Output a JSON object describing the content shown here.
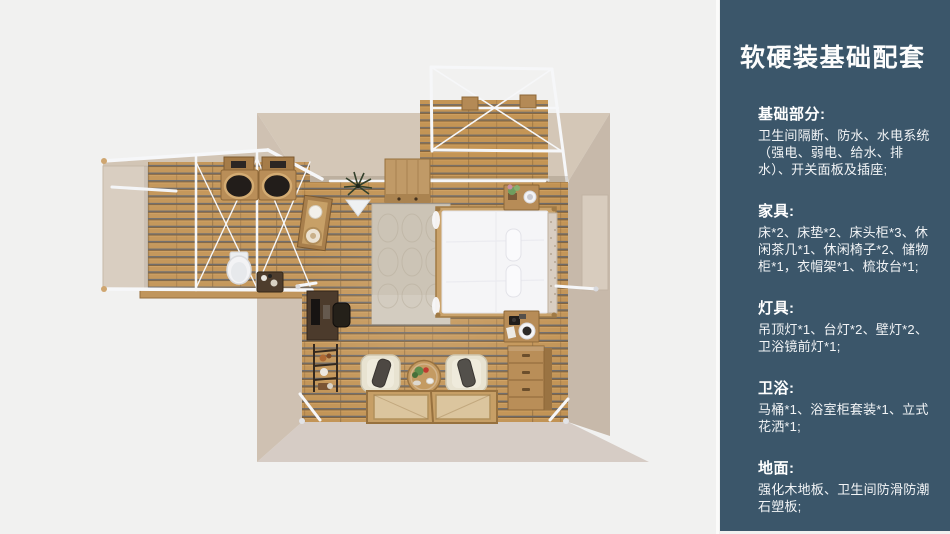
{
  "page": {
    "background": "#f1f1f0",
    "divider_color": "#fbfbfa"
  },
  "floorplan": {
    "kind": "3D top-down room render",
    "depicts": [
      "main bedroom with wood slat floor",
      "double bed with white duvet",
      "rug",
      "two lounge chairs",
      "round tea table",
      "floor mats",
      "dresser",
      "nightstands",
      "desk and chair",
      "ladder shelf",
      "storage cabinet",
      "plant",
      "bathroom wing with two sinks",
      "toilet",
      "towel shelf",
      "wardrobe nook",
      "white frame trusses",
      "balcony deck"
    ],
    "colors": {
      "wood_base": "#c29354",
      "wood_line_blue": "#59616e",
      "wood_line_brown": "#7e5f38",
      "wall_beige": "#d4c7b7",
      "wall_beige_dark": "#c7b9aa",
      "truss_white": "#f6f7f9",
      "bed_white": "#f5f5f7"
    }
  },
  "sidebar": {
    "background": "#3b566a",
    "text_color": "#ffffff",
    "title": "软硬装基础配套",
    "sections": [
      {
        "heading": "基础部分:",
        "body": "卫生间隔断、防水、水电系统（强电、弱电、给水、排水）、开关面板及插座;"
      },
      {
        "heading": "家具:",
        "body": "床*2、床垫*2、床头柜*3、休闲茶几*1、休闲椅子*2、储物柜*1，衣帽架*1、梳妆台*1;"
      },
      {
        "heading": "灯具:",
        "body": "吊顶灯*1、台灯*2、壁灯*2、卫浴镜前灯*1;"
      },
      {
        "heading": "卫浴:",
        "body": "马桶*1、浴室柜套装*1、立式花洒*1;"
      },
      {
        "heading": "地面:",
        "body": "强化木地板、卫生间防滑防潮石塑板;"
      }
    ]
  }
}
